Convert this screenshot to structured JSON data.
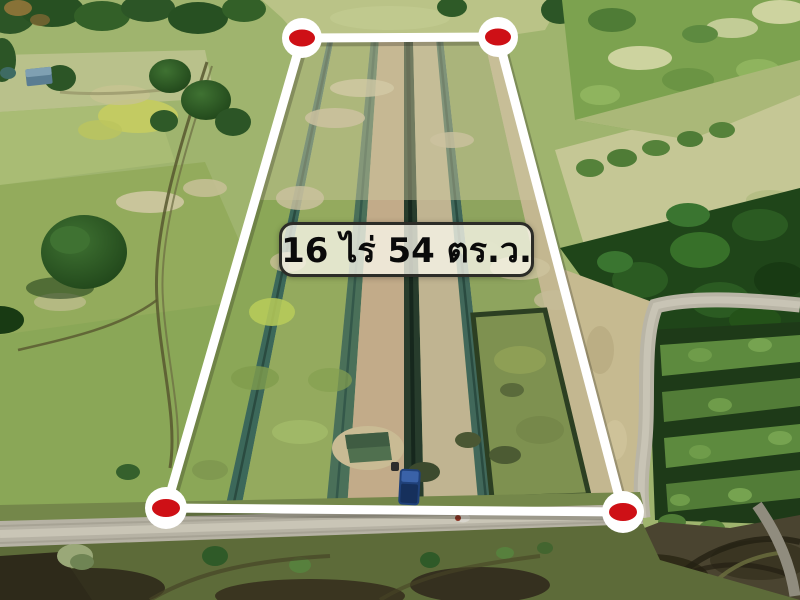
{
  "image": {
    "description": "Aerial drone photograph of an agricultural land plot outlined for sale, with canals, fields, forest, orchard rows and a dirt road"
  },
  "overlay": {
    "area_label": "16 ไร่ 54 ตร.ว.",
    "label_style": {
      "text_color": "#0a0a0a",
      "background": "rgba(249,246,234,0.78)",
      "border_color": "#2c2c27"
    },
    "boundary_color": "#ffffff",
    "marker_color": "#ce1016",
    "marker_ring_color": "#ffffff",
    "corners": [
      "top-left",
      "top-right",
      "bottom-right",
      "bottom-left"
    ]
  }
}
